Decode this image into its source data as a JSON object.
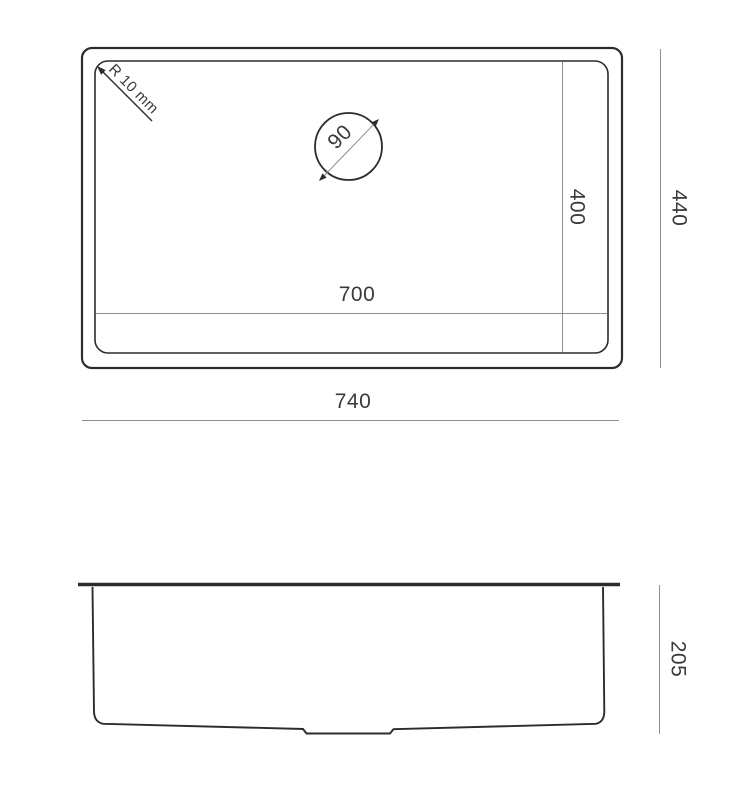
{
  "colors": {
    "outline": "#2c2c2c",
    "dim": "#8e8e8e",
    "label": "#3a3a3a"
  },
  "top_view": {
    "outer_width": "740",
    "outer_height": "440",
    "inner_width": "700",
    "inner_height": "400",
    "drain_hole_diameter": "90",
    "corner_radius": "R 10 mm"
  },
  "side_view": {
    "depth": "205"
  }
}
